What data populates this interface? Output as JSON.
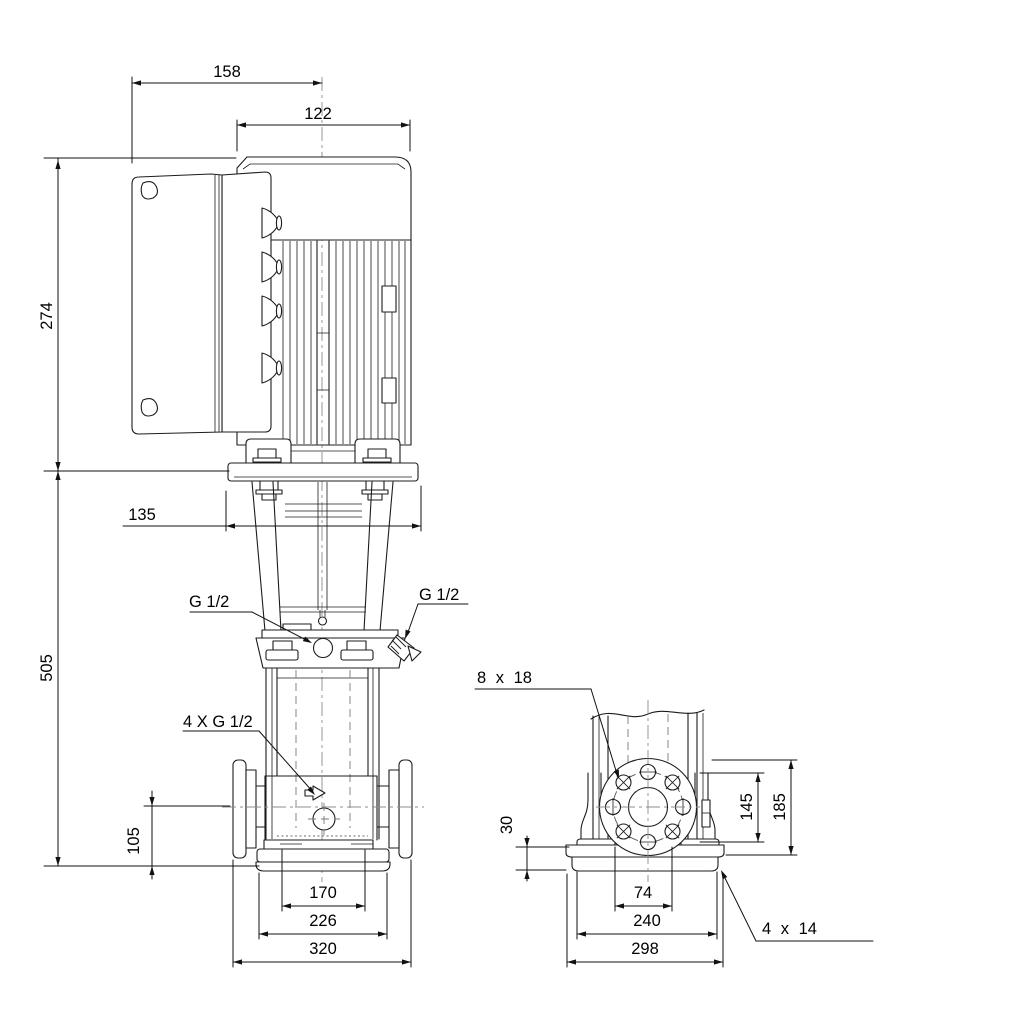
{
  "drawing": {
    "background": "#ffffff",
    "line_color": "#1c1c1c",
    "centerline_color": "#8c8c8c",
    "dims": {
      "d158": "158",
      "d122": "122",
      "d274": "274",
      "d135": "135",
      "d505": "505",
      "d105": "105",
      "g12_left": "G 1/2",
      "g12_right": "G 1/2",
      "g12_drain": "4 X G 1/2",
      "d170": "170",
      "d226": "226",
      "d320": "320",
      "holes_flange": "8 x 18",
      "d30": "30",
      "d145": "145",
      "d185": "185",
      "d74": "74",
      "d240": "240",
      "d298": "298",
      "holes_base": "4 x 14"
    }
  }
}
